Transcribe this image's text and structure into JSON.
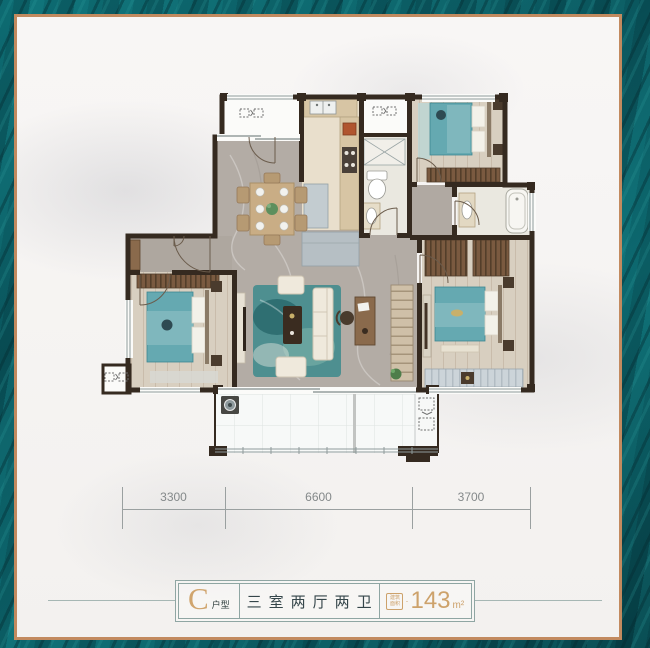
{
  "frame": {
    "background_teal": "#0a5d64",
    "copper_border": "#c28a5f",
    "marble_interior": "#f6f4f3"
  },
  "floor_plan": {
    "wall_color": "#352a20",
    "bed_color": "#65a9b1",
    "marble_floor": "#b3aca5",
    "wood_floor": "#d8cfc0",
    "wardrobe_brown": "#7a5a40",
    "rug_teal": "#4e8f90"
  },
  "ruler": {
    "labels": [
      "3300",
      "6600",
      "3700"
    ]
  },
  "plate": {
    "type_letter": "C",
    "type_suffix": "户型",
    "rooms_label": "三室两厅两卫",
    "area_badge_top": "建筑",
    "area_badge_bottom": "面积",
    "area_sep": "·",
    "area_value": "143",
    "area_unit": "m²",
    "gold": "#cda26b",
    "text_dark": "#35464a"
  }
}
